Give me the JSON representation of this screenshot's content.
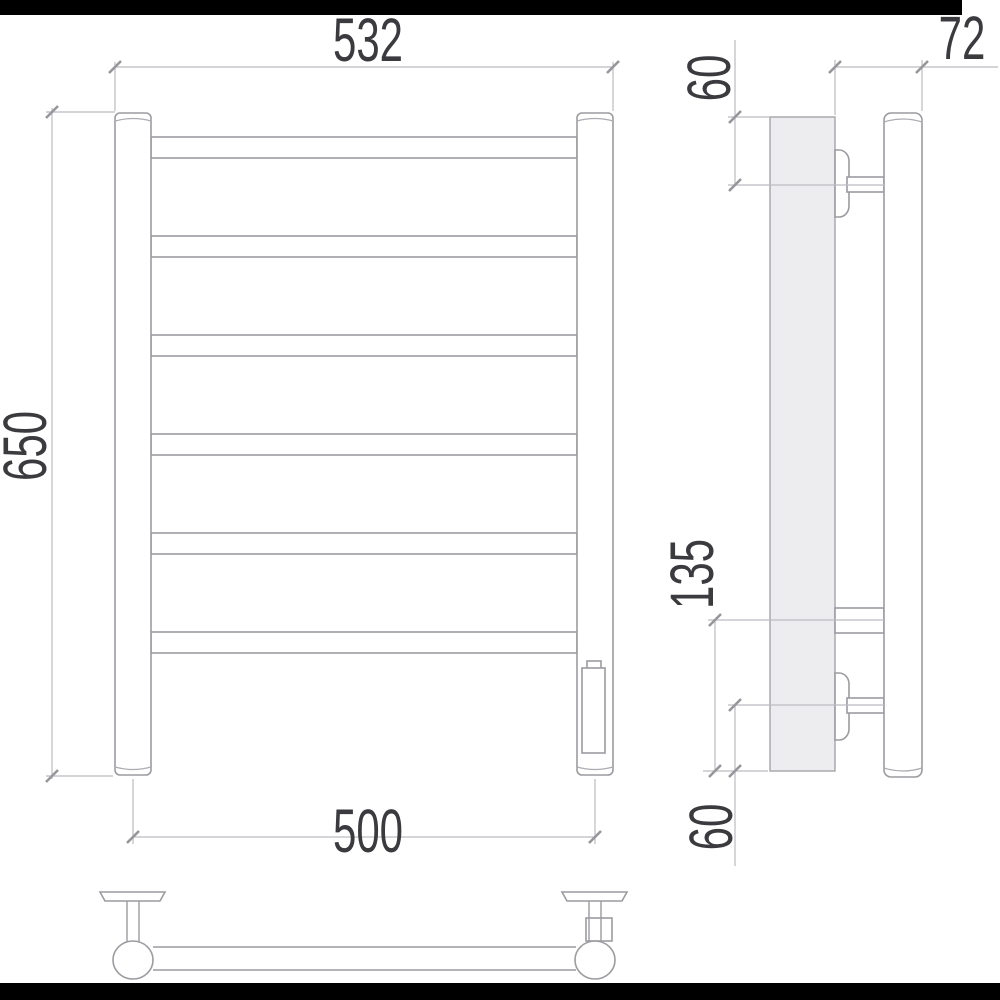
{
  "document": {
    "kind": "technical-drawing",
    "subject": "towel-rail three-view dimensional drawing"
  },
  "colors": {
    "background": "#ffffff",
    "mask_bar": "#000000",
    "object_line": "#9b9ba1",
    "dimension_line": "#bcbcc2",
    "wall_plate_fill": "#ededef",
    "text": "#3b3b3f"
  },
  "views": {
    "front": {
      "rail_count": 6,
      "dimensions": {
        "overall_width": "532",
        "overall_height": "650",
        "mounting_width": "500"
      }
    },
    "side": {
      "dimensions": {
        "depth": "72",
        "top_bracket_offset": "60",
        "lower_span": "135",
        "bottom_bracket_offset": "60"
      }
    },
    "bottom": {}
  }
}
